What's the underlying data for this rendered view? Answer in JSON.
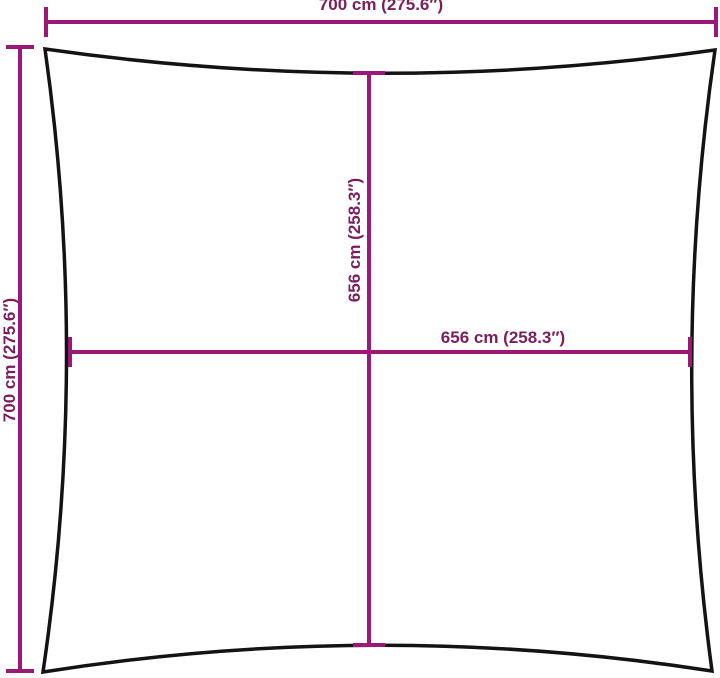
{
  "dimensions": {
    "top": {
      "label": "700 cm (275.6″)"
    },
    "left": {
      "label": "700 cm (275.6″)"
    },
    "vertical_center": {
      "label": "656 cm (258.3″)"
    },
    "horizontal_center": {
      "label": "656 cm (258.3″)"
    }
  },
  "colors": {
    "dimension_line": "#9C1878",
    "dimension_text": "#7B1E5C",
    "sail_outline": "#131313",
    "background": "#FFFFFF"
  }
}
